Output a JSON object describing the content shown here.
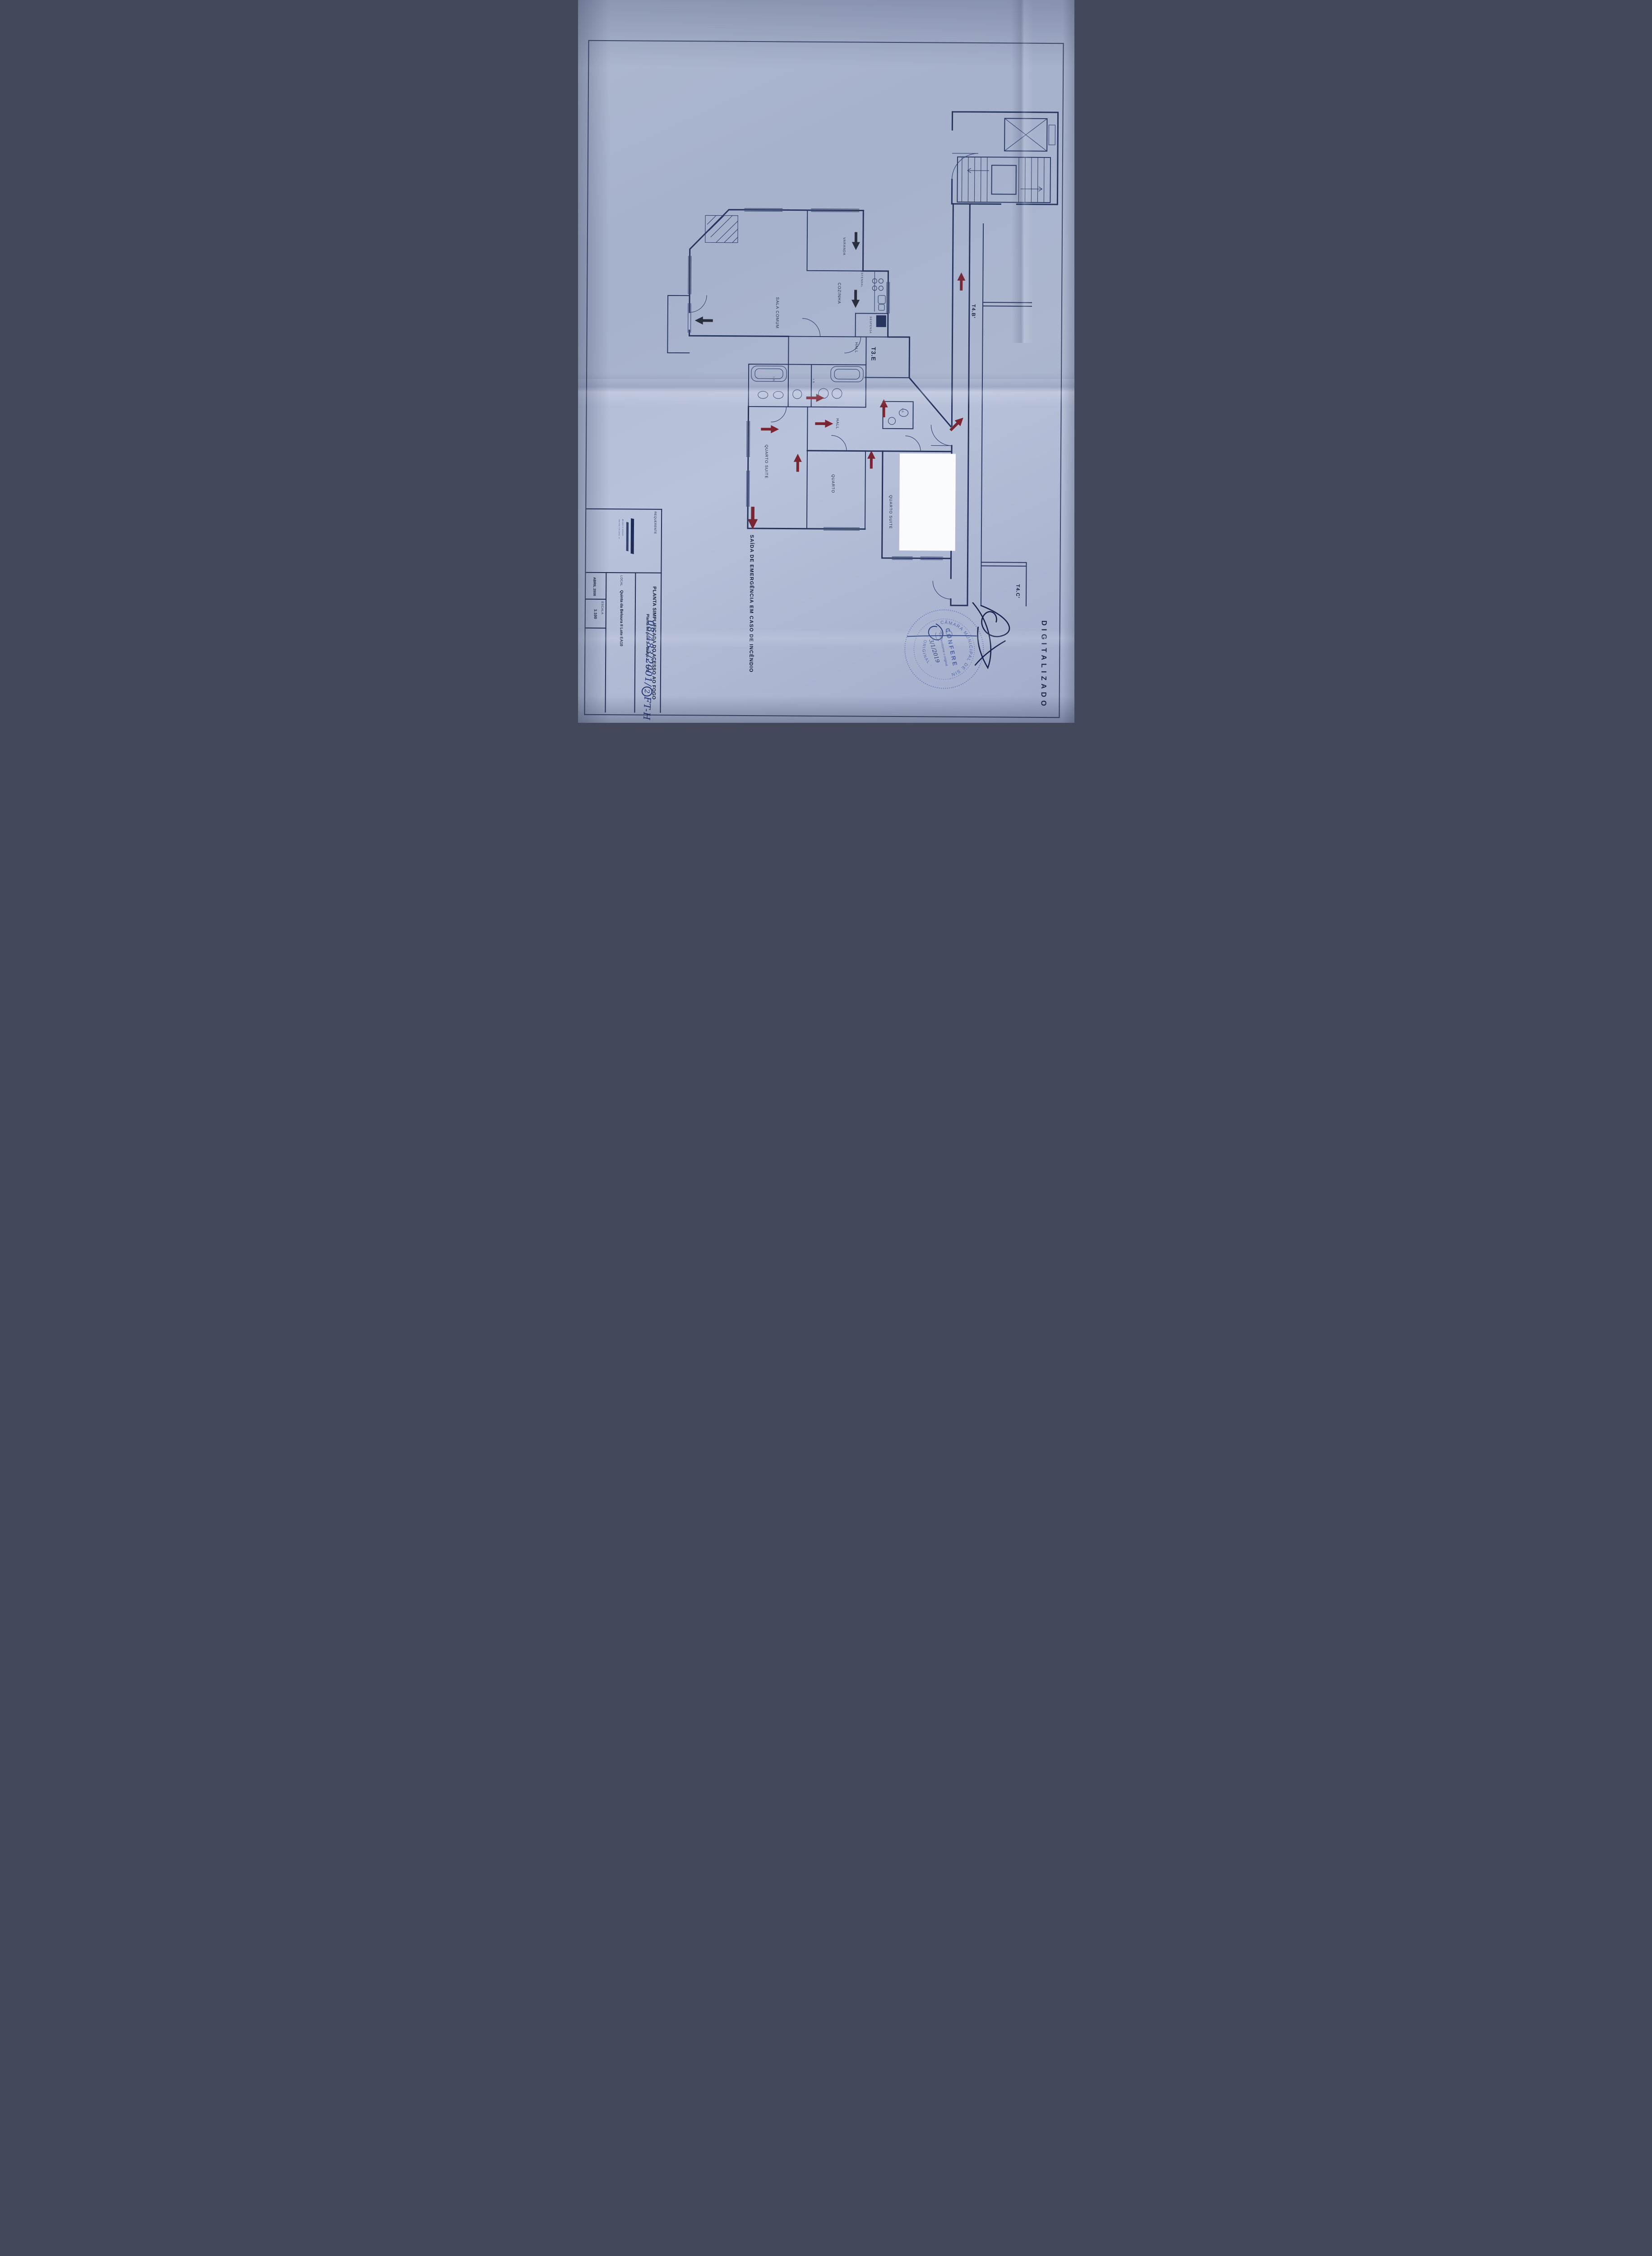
{
  "document": {
    "watermark": "DIGITALIZADO",
    "emergency_note": "SAÍDA DE EMERGÊNCIA EM CASO DE INCÊNDIO",
    "handwritten_ref_before": "08/483/2001/",
    "handwritten_ref_circled": "2",
    "handwritten_ref_after": "FT-H"
  },
  "title_block": {
    "requerente_label": "REQUERENTE",
    "title_line1": "PLANTA SIMPLIFICADA DO ACESSO AO FOGO",
    "title_line2": "Planta do piso 2 - Bloco 1 - T3 E",
    "local_label": "LOCAL",
    "local_value": "Quinta da Beloura II    Lote EA10",
    "date_value": "ABRIL 2008",
    "scale_label": "ESCALA",
    "scale_value": "1:100"
  },
  "stamp": {
    "rim_top": "CÂMARA MUNICIPAL DE SINTRA",
    "rim_bottom": "· ORIGINAL ·",
    "center": "CONFERE",
    "line": "Está conforme o original",
    "handwritten_date": "3/1/2019"
  },
  "plan": {
    "unit_label": "T3.E",
    "neighbor_top": "T4.B'",
    "neighbor_right": "T4.C'",
    "rooms": {
      "sala": "SALA COMUM",
      "cozinha": "COZINHA",
      "hall1": "HALL",
      "hall2": "HALL",
      "quarto_suite1": "QUARTO SUITE",
      "quarto": "QUARTO",
      "quarto_suite2": "QUARTO SUITE",
      "varanda": "VARANDA",
      "despensa": "DESPENSA",
      "estendal": "ESTENDAL",
      "is1": "I.S.",
      "is2": "I.S.",
      "is3": "I.S."
    }
  },
  "colors": {
    "ink": "#24325c",
    "arrow_red": "#7c2532",
    "arrow_black": "#262b36",
    "stamp_blue": "#4a5fa8",
    "paper": "#b3bdd6"
  }
}
